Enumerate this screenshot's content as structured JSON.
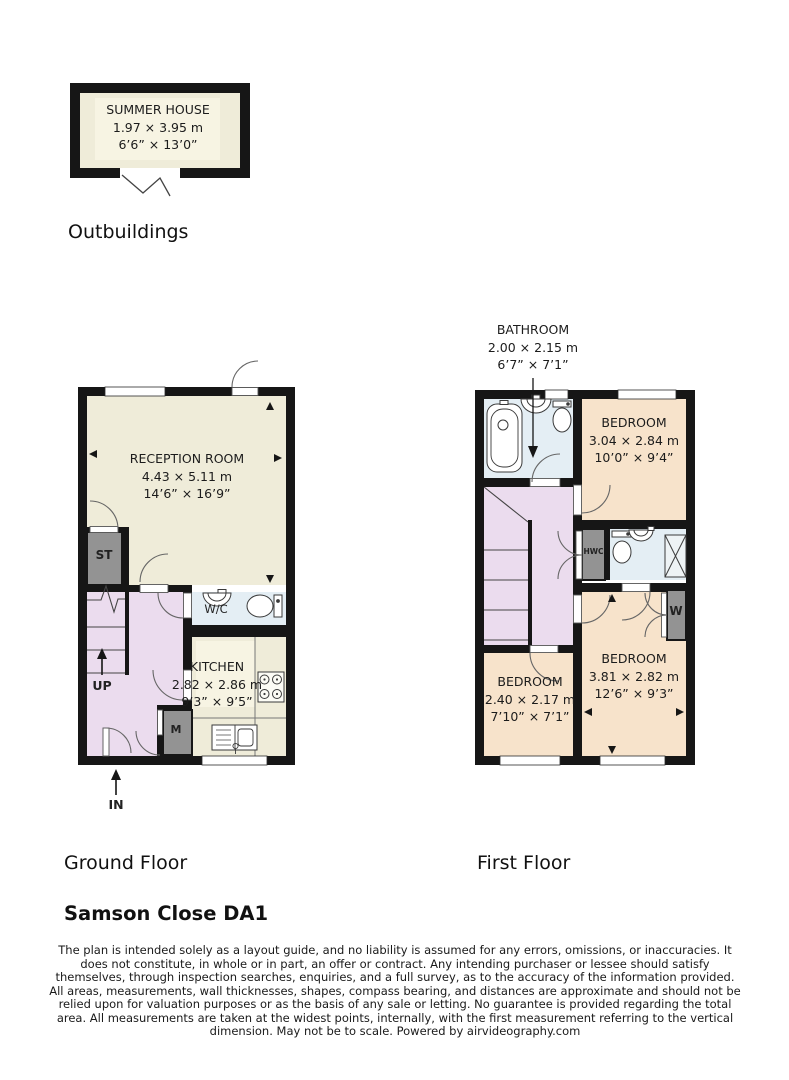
{
  "palette": {
    "wall": "#161616",
    "cream_room": "#efecd9",
    "cream_inset": "#f7f4e3",
    "pink_hall": "#ebdcee",
    "blue_wet_room": "#e4eef4",
    "peach_bedroom": "#f7e3cb",
    "gray_cupboard": "#939393"
  },
  "outbuildings": {
    "section_label": "Outbuildings",
    "summer_house": {
      "name": "SUMMER HOUSE",
      "dims_metric": "1.97 × 3.95 m",
      "dims_imperial": "6’6” × 13’0”"
    }
  },
  "ground_floor": {
    "section_label": "Ground Floor",
    "reception": {
      "name": "RECEPTION ROOM",
      "dims_metric": "4.43 × 5.11 m",
      "dims_imperial": "14’6” × 16’9”"
    },
    "kitchen": {
      "name": "KITCHEN",
      "dims_metric": "2.82 × 2.86 m",
      "dims_imperial": "9’3” × 9’5”"
    },
    "wc_label": "W/C",
    "storage_label": "ST",
    "meter_label": "M",
    "up_label": "UP",
    "entrance_label": "IN"
  },
  "first_floor": {
    "section_label": "First Floor",
    "bathroom": {
      "name": "BATHROOM",
      "dims_metric": "2.00 × 2.15 m",
      "dims_imperial": "6’7” × 7’1”"
    },
    "bedroom_top": {
      "name": "BEDROOM",
      "dims_metric": "3.04 × 2.84 m",
      "dims_imperial": "10’0” × 9’4”"
    },
    "bedroom_right": {
      "name": "BEDROOM",
      "dims_metric": "3.81 × 2.82 m",
      "dims_imperial": "12’6” × 9’3”"
    },
    "bedroom_left": {
      "name": "BEDROOM",
      "dims_metric": "2.40 × 2.17 m",
      "dims_imperial": "7’10” × 7’1”"
    },
    "hwc_label": "HWC",
    "wardrobe_label": "W"
  },
  "footer": {
    "address": "Samson Close DA1",
    "disclaimer": "The plan is intended solely as a layout guide, and no liability is assumed for any errors, omissions, or inaccuracies. It does not constitute, in whole or in part, an offer or contract. Any intending purchaser or lessee should satisfy themselves, through inspection searches, enquiries, and a full survey, as to the accuracy of the information provided. All areas, measurements, wall thicknesses, shapes, compass bearing, and distances are approximate and should not be relied upon for valuation purposes or as the basis of any sale or letting. No guarantee is provided regarding the total area. All measurements are taken at the widest points, internally, with the first measurement referring to the vertical dimension. May not be to scale. Powered by airvideography.com"
  }
}
